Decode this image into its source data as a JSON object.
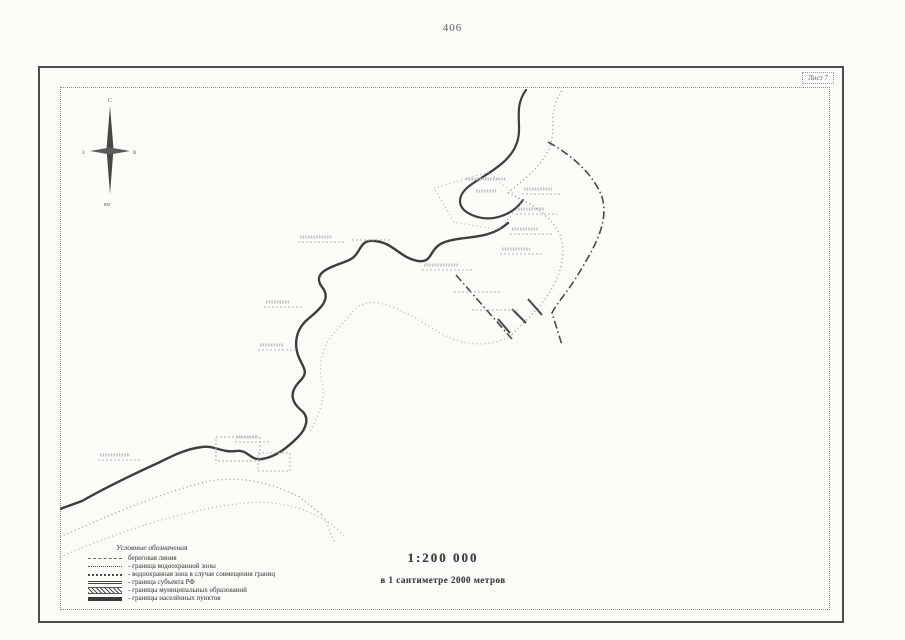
{
  "page": {
    "number": "406"
  },
  "sheet": {
    "corner_label": "Лист 7"
  },
  "compass": {
    "north": "С",
    "south": "Ю",
    "west": "З",
    "east": "В",
    "caption": "юг"
  },
  "legend": {
    "title": "Условные обозначения",
    "items": [
      {
        "style": "coastline",
        "label": "береговая линия"
      },
      {
        "style": "wpz-boundary",
        "label": "- граница водоохранной зоны"
      },
      {
        "style": "wpz-combined",
        "label": "- водоохранная зона в случае совмещения границ"
      },
      {
        "style": "rf-subject-boundary",
        "label": "- граница субъекта РФ"
      },
      {
        "style": "municipal-boundary",
        "label": "- границы муниципальных образований"
      },
      {
        "style": "settlement-boundary",
        "label": "- границы населённых пунктов"
      }
    ]
  },
  "scale": {
    "ratio": "1:200 000",
    "caption": "в 1 сантиметре 2000 метров"
  },
  "colors": {
    "ink": "#3e3e3e",
    "faint": "#9c9c9c",
    "frame": "#4c4c4c",
    "paper": "#fbfbf8"
  }
}
